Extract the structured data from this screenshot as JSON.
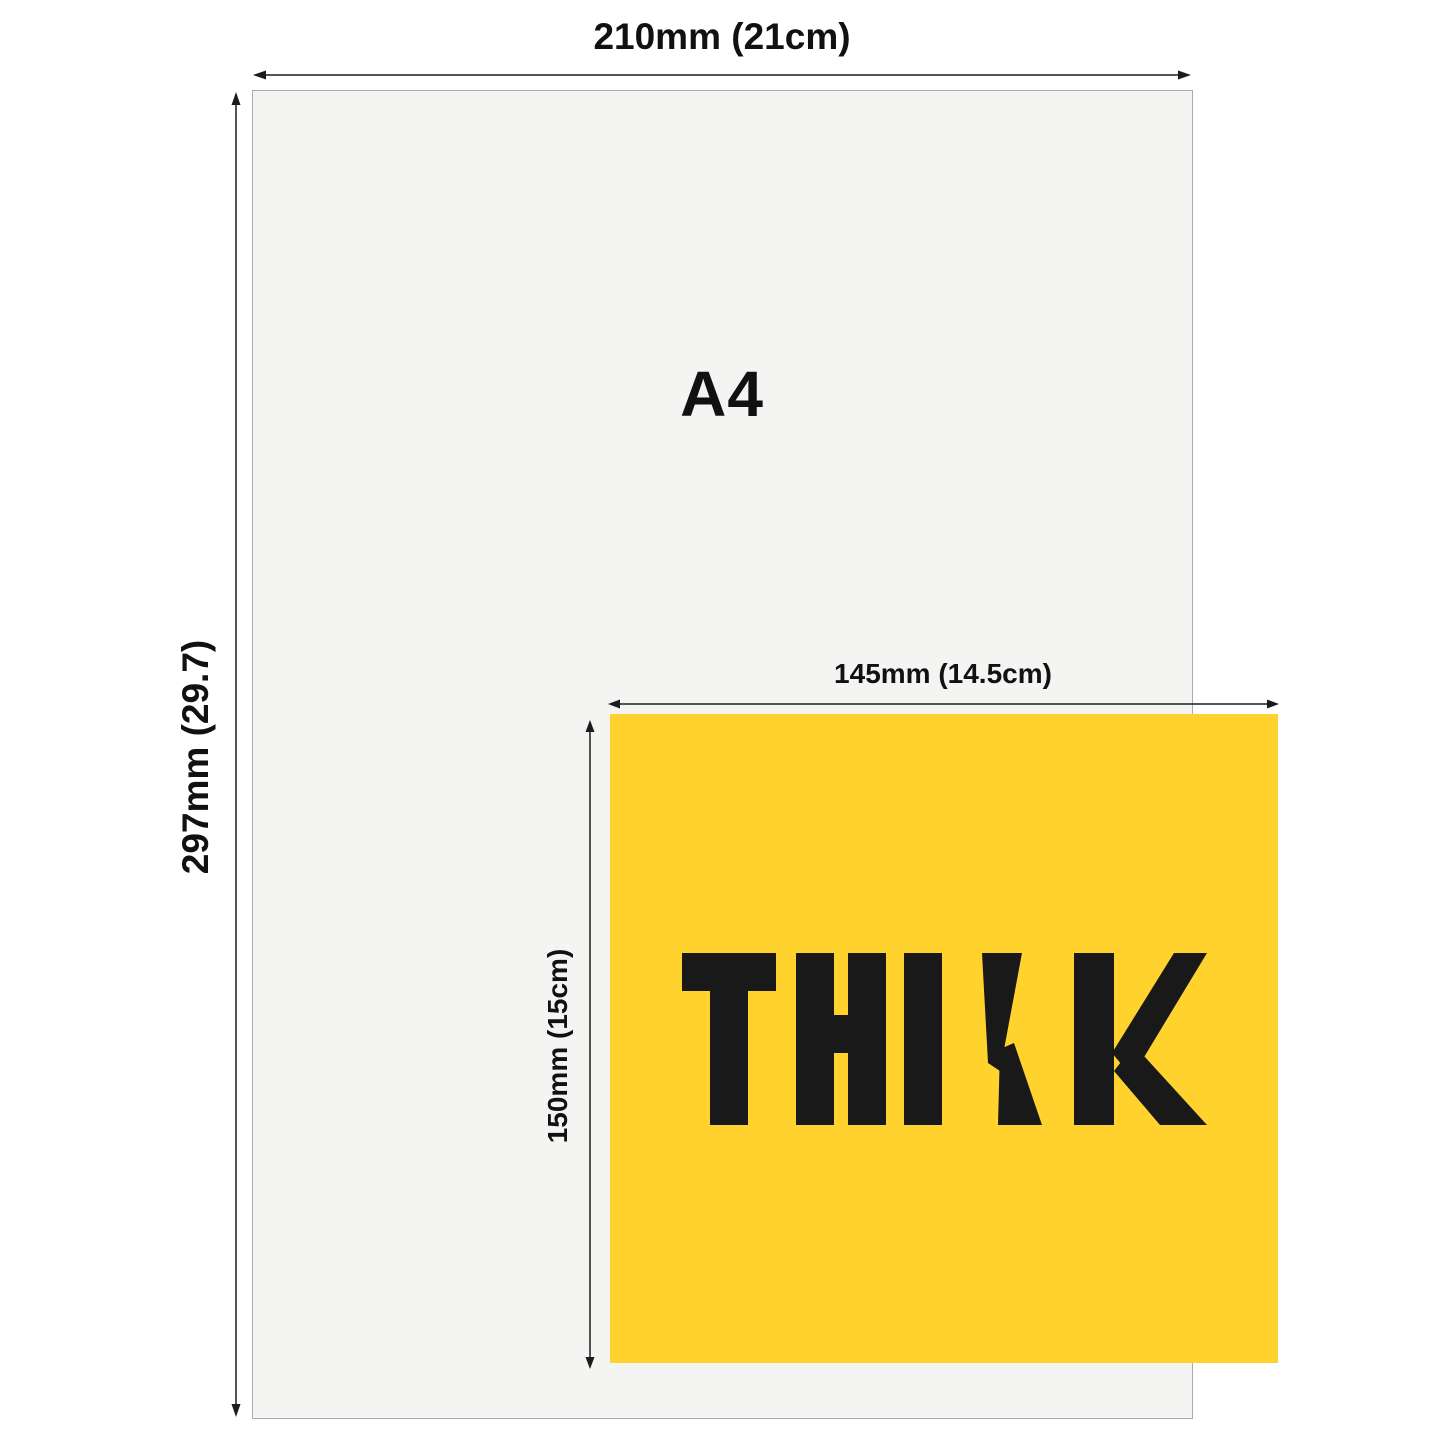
{
  "diagram": {
    "title": "A4 vs sticker size comparison",
    "a4": {
      "label": "A4",
      "width_label": "210mm (21cm)",
      "height_label": "297mm (29.7)"
    },
    "sticker": {
      "label": "THINK",
      "width_label": "145mm (14.5cm)",
      "height_label": "150mm (15cm)"
    },
    "colors": {
      "background": "#ffffff",
      "sheet_gray": "#f4f4f3",
      "sheet_border": "#ababab",
      "sticker_yellow": "#ffd22e",
      "ink": "#191919",
      "arrow": "#1c1c1c"
    }
  }
}
